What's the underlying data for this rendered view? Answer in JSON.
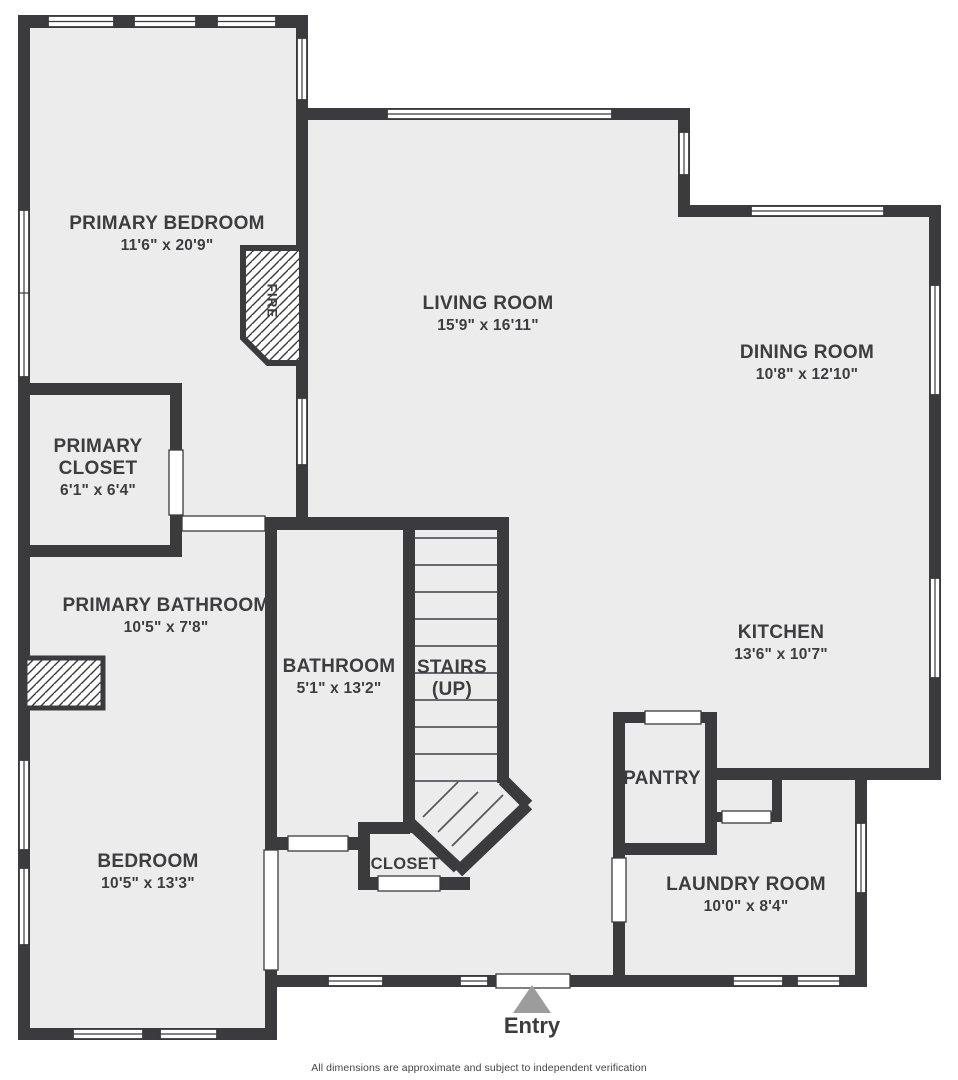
{
  "colors": {
    "wall": "#3b3b3d",
    "floor": "#ececec",
    "background": "#ffffff",
    "entry_arrow": "#9c9c9c",
    "label_text": "#3d3d3f"
  },
  "rooms": [
    {
      "id": "primary-bedroom",
      "name": "PRIMARY BEDROOM",
      "dims": "11'6\" x 20'9\""
    },
    {
      "id": "primary-closet",
      "name": "PRIMARY CLOSET",
      "dims": "6'1\" x 6'4\""
    },
    {
      "id": "primary-bathroom",
      "name": "PRIMARY BATHROOM",
      "dims": "10'5\" x 7'8\""
    },
    {
      "id": "bedroom",
      "name": "BEDROOM",
      "dims": "10'5\" x 13'3\""
    },
    {
      "id": "living-room",
      "name": "LIVING ROOM",
      "dims": "15'9\" x 16'11\""
    },
    {
      "id": "dining-room",
      "name": "DINING ROOM",
      "dims": "10'8\" x 12'10\""
    },
    {
      "id": "kitchen",
      "name": "KITCHEN",
      "dims": "13'6\" x 10'7\""
    },
    {
      "id": "pantry",
      "name": "PANTRY",
      "dims": ""
    },
    {
      "id": "laundry-room",
      "name": "LAUNDRY ROOM",
      "dims": "10'0\" x 8'4\""
    },
    {
      "id": "bathroom",
      "name": "BATHROOM",
      "dims": "5'1\" x 13'2\""
    },
    {
      "id": "stairs",
      "name": "STAIRS",
      "note": "(UP)"
    },
    {
      "id": "closet",
      "name": "CLOSET",
      "dims": ""
    }
  ],
  "labels": {
    "fireplace": "FIRE",
    "entry": "Entry"
  },
  "footer": "All dimensions are approximate and subject to independent verification"
}
